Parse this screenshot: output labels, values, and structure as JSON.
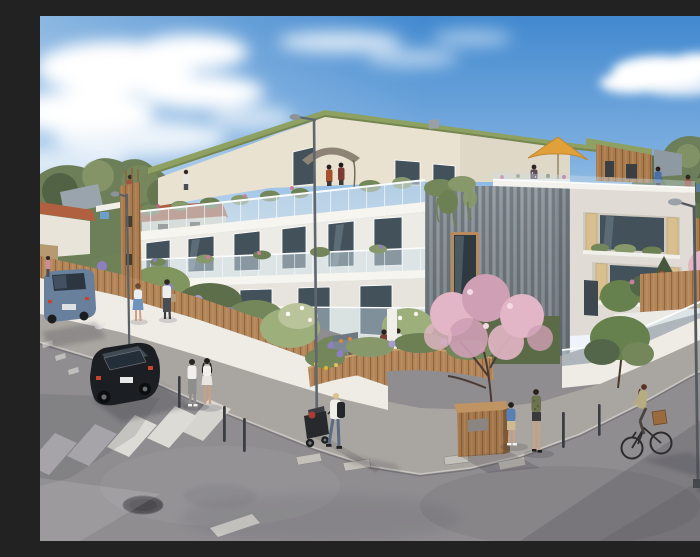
{
  "scene": {
    "type": "architectural-rendering",
    "setting": "sunny street corner with a new residential building",
    "description": "Photorealistic architect's rendering of a modern three-storey apartment building on a sunny street corner: green vegetated roof, cream attic level, white balconies with glass railings and hanging plants, weathered grey timber cladding at the corner, timber shutters on loggias, roof terraces with a grey and a yellow parasol, gardens with lavender and blossoming magnolia trees behind a low white wall topped with a wooden fence, asphalt streets with a zebra crossing, bollards, street lamps, a parked black hatchback, pedestrians, a person pushing a stroller and a woman cycling.",
    "weather": "sunny",
    "sky": "blue with scattered white clouds"
  },
  "palette": {
    "sky_top": "#4289cf",
    "sky_mid": "#7fb0e0",
    "sky_low": "#c3dcf0",
    "sky_horizon": "#eef4f9",
    "cloud": "#ffffff",
    "foliage": "#6d7f58",
    "foliage_dark": "#526245",
    "foliage_light": "#8a9a6c",
    "green_roof": "#8fa162",
    "green_roof_dark": "#75874f",
    "attic_cream": "#e9e2d1",
    "facade_white": "#ecebe5",
    "slab_white": "#f7f5f0",
    "window_dark": "#43515b",
    "glass_tint": "#cddde6",
    "clad_gray": "#8b9499",
    "wood": "#b28457",
    "wood_dark": "#8d6239",
    "wood_light": "#c9a06d",
    "shutter": "#d9bf8e",
    "lavender": "#8d80c2",
    "blossom": "#e2b6c6",
    "blossom_dark": "#cfa0b5",
    "wall_white": "#efece6",
    "asphalt": "#8f8d90",
    "asphalt_light": "#a8a39d",
    "sidewalk": "#a9a5a0",
    "marking": "#dddbd6",
    "marking_dim": "#b9b7bb",
    "parasol_yellow": "#e0a13a",
    "parasol_gray": "#8d8476",
    "car_black": "#1b1e22",
    "car_blue": "#68809c",
    "taillight": "#c8432c",
    "skin": "#caa183",
    "denim": "#5b6b84",
    "shadow": "#3e3c46"
  },
  "building": {
    "floors": 3,
    "features": [
      "green roof",
      "roof terraces",
      "glass balcony railings",
      "hanging plants",
      "grey weathered timber cladding",
      "timber shutters",
      "recessed loggias"
    ],
    "parasols": [
      {
        "name": "grey-parasol",
        "color": "#8d8476"
      },
      {
        "name": "yellow-parasol",
        "color": "#e0a13a"
      }
    ]
  },
  "street": {
    "markings": [
      "zebra crossing",
      "lane dashes",
      "stop dash"
    ],
    "furniture": [
      "street lamp tall",
      "street lamp left",
      "street lamp right",
      "bollards",
      "timber utility shed",
      "manhole cover",
      "curb stones"
    ],
    "vehicles": [
      {
        "name": "black-hatchback",
        "color": "#1b1e22",
        "state": "parked"
      },
      {
        "name": "blue-grey-car",
        "color": "#68809c",
        "state": "parked, left edge"
      }
    ]
  },
  "people": [
    {
      "name": "pedestrian-distant",
      "where": "far left sidewalk"
    },
    {
      "name": "woman-blue-skirt",
      "where": "left sidewalk"
    },
    {
      "name": "pedestrian-white-top",
      "where": "left sidewalk"
    },
    {
      "name": "man-white-tshirt",
      "where": "corner sidewalk"
    },
    {
      "name": "woman-white-outfit",
      "where": "corner sidewalk"
    },
    {
      "name": "person-with-stroller",
      "where": "corner sidewalk"
    },
    {
      "name": "man-blue-tshirt",
      "where": "near shed"
    },
    {
      "name": "person-camo-jacket",
      "where": "near magnolia tree"
    },
    {
      "name": "woman-cyclist",
      "where": "right street"
    },
    {
      "name": "couple-under-grey-parasol",
      "where": "roof terrace"
    },
    {
      "name": "person-yellow-parasol",
      "where": "roof terrace"
    },
    {
      "name": "person-blue-top-roof",
      "where": "right roof terrace"
    },
    {
      "name": "person-red-top-roof",
      "where": "right roof terrace"
    },
    {
      "name": "residents-ground-terrace",
      "where": "corner garden terrace"
    },
    {
      "name": "woman-on-balcony",
      "where": "first floor balcony"
    }
  ]
}
